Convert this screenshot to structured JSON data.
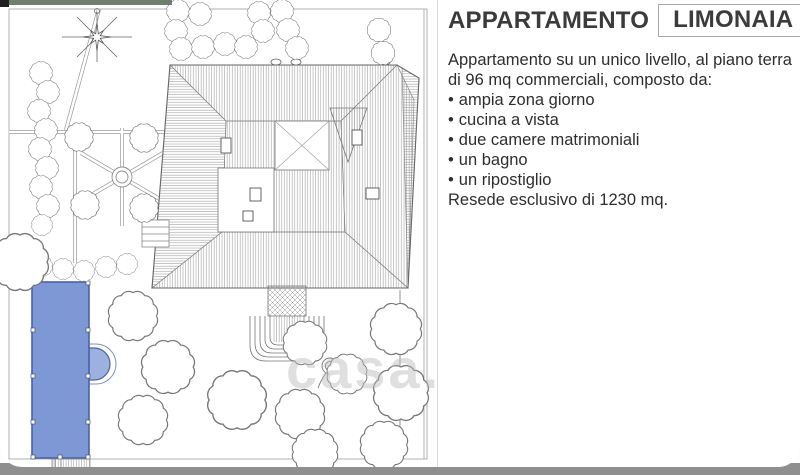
{
  "listing": {
    "title_main": "APPARTAMENTO",
    "title_highlight": "LIMONAIA",
    "description_line1": "Appartamento su un unico livello, al piano terra",
    "description_line2": "di 96 mq commerciali, composto da:",
    "bullet": "•",
    "features": [
      "ampia zona giorno",
      "cucina a vista",
      "due camere matrimoniali",
      "un bagno",
      "un ripostiglio"
    ],
    "footer": "Resede esclusivo di 1230 mq."
  },
  "watermark": "casa.it",
  "colors": {
    "pool_fill": "#7e98d5",
    "pool_edge": "#4c62a8",
    "top_bar_green": "#6f7e6e",
    "bottom_bar_gray": "#8f8f8f",
    "ink": "#777777",
    "title_box_border": "#a6a6a6"
  }
}
